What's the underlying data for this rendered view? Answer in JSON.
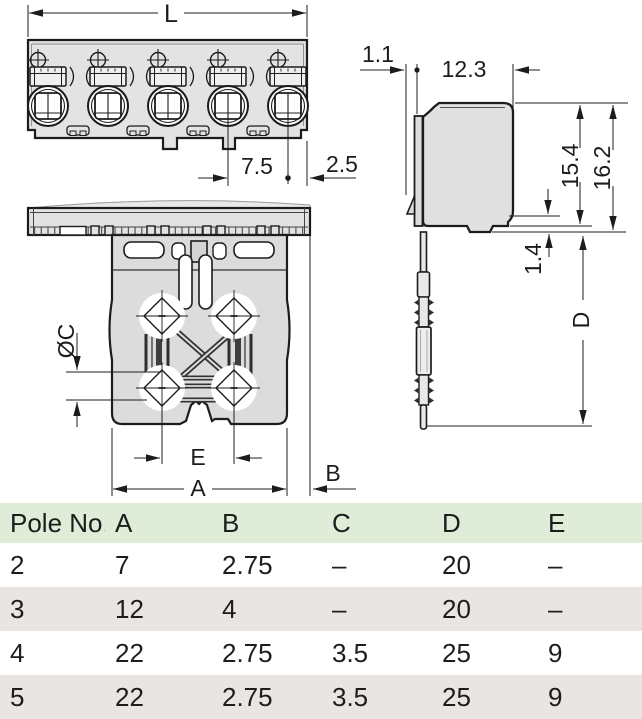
{
  "drawing": {
    "front_view": {
      "label_L": "L",
      "label_pitch": "7.5",
      "label_edge": "2.5"
    },
    "side_view": {
      "label_offset": "1.1",
      "label_depth": "12.3",
      "label_height_body": "15.4",
      "label_height_total": "16.2",
      "label_step": "1.4",
      "label_pin_length": "D"
    },
    "bottom_view": {
      "label_diameter": "ØC",
      "label_e": "E",
      "label_a": "A",
      "label_b": "B"
    }
  },
  "table": {
    "headers": [
      "Pole No.",
      "A",
      "B",
      "C",
      "D",
      "E"
    ],
    "rows": [
      [
        "2",
        "7",
        "2.75",
        "–",
        "20",
        "–"
      ],
      [
        "3",
        "12",
        "4",
        "–",
        "20",
        "–"
      ],
      [
        "4",
        "22",
        "2.75",
        "3.5",
        "25",
        "9"
      ],
      [
        "5",
        "22",
        "2.75",
        "3.5",
        "25",
        "9"
      ]
    ]
  },
  "colors": {
    "table_header_bg": "#deecd8",
    "table_alt_row_bg": "#e8e5e3",
    "drawing_line": "#1c1c1c",
    "body_fill": "#e0e0e0"
  }
}
